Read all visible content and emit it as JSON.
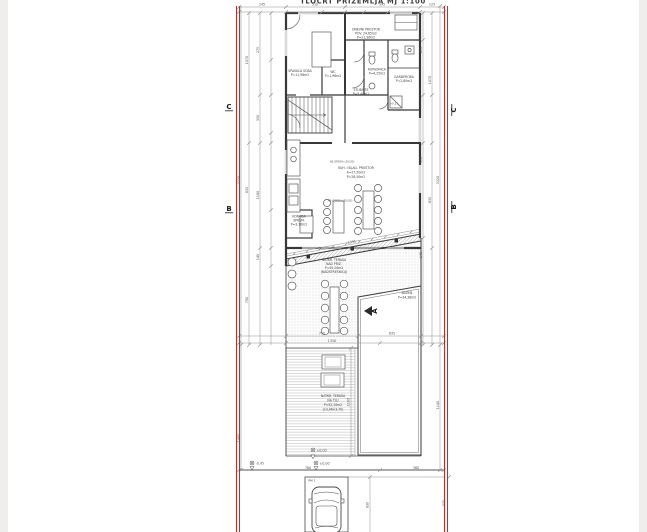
{
  "page": {
    "title": "TLOCRT PRIZEMLJA  MJ 1:100"
  },
  "colors": {
    "property_line": "#a23b32",
    "wall": "#383838",
    "dimension_line": "#8f8f8f",
    "terrace_dots": "#b9b9b9",
    "deck_stripes": "#c9c9c9"
  },
  "section_markers": {
    "c": "C",
    "b": "B",
    "a": "A"
  },
  "labels": {
    "bedroom": [
      "SPAVAĆA SOBA",
      "P=11,96m2"
    ],
    "wc": [
      "WC",
      "P=1,96m2"
    ],
    "living": [
      "DNEVNI PROSTOR",
      "POV. 24,65m2",
      "P=21,36m2"
    ],
    "bath": [
      "KUPAONICA",
      "P=4,25m2"
    ],
    "wardrobe": [
      "GARDEROBA",
      "P=2,80m2"
    ],
    "stairs": [
      "STUBIŠTE",
      "P=5,40m2"
    ],
    "dining": [
      "KUH. I BLAG. PROSTOR",
      "A=27,50m2",
      "P=28,50m2"
    ],
    "beam": "AB GREDA (20/30)",
    "storage": [
      "KONOBA",
      "SPREM.",
      "P=3,10m2"
    ],
    "terrace_upper": [
      "NATKR. TERASA",
      "NAD PRIZ.",
      "P=45,20m2",
      "(NADSTREŠNICA)"
    ],
    "pool": [
      "BAZEN",
      "P=34,38m2"
    ],
    "terrace_lower": [
      "NATKR. TERASA",
      "NA TLU",
      "P=52,10m2",
      "(13,96×3,70)"
    ],
    "parking": "PM 1",
    "level_inside": "+0,15",
    "lev_a": "±0,00",
    "lev_b": "-0,45",
    "lev_c": "±0,00"
  },
  "dims": {
    "t1": "245",
    "t2": "510",
    "t3": "395",
    "t4": "125",
    "l1": "1070",
    "l2": "835",
    "l3": "790",
    "l4": "275",
    "l5": "350",
    "l6": "1180",
    "l7": "140",
    "l8": "3320",
    "l9": "1485",
    "r1": "275",
    "r2": "970",
    "r3": "140",
    "r4": "1070",
    "r5": "835",
    "r6": "3320",
    "r7": "1140",
    "r8": "525",
    "m1": "750",
    "m2": "635",
    "m3": "1350",
    "b1": "760",
    "b2": "360",
    "d1": "1100",
    "d2": "830",
    "dg": "1395"
  }
}
